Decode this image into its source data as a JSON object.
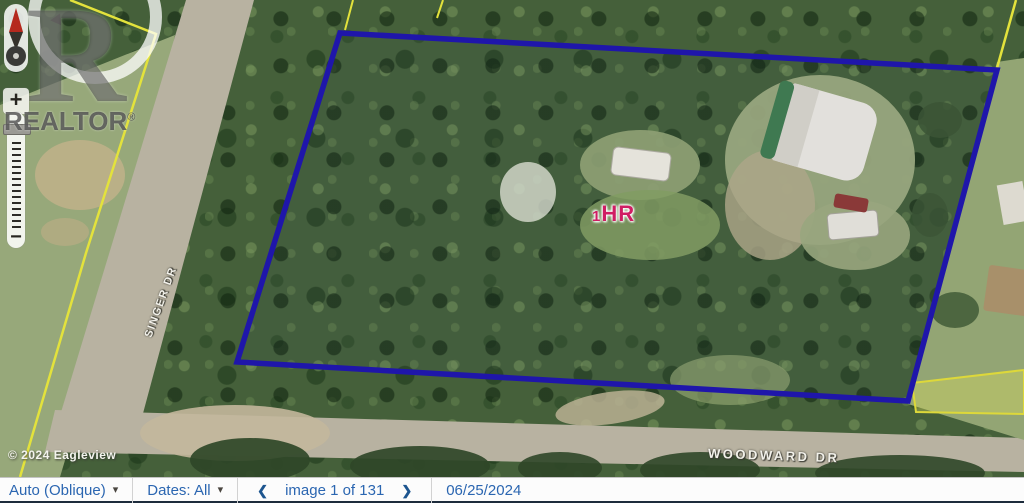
{
  "watermark": {
    "logo_letter": "R",
    "name": "REALTOR",
    "registered_mark": "®"
  },
  "zoom_control": {
    "zoom_in_label": "+",
    "zoom_out_label": "−"
  },
  "map": {
    "copyright": "© 2024 Eagleview",
    "street_labels": [
      {
        "text": "SINGER DR"
      },
      {
        "text": "WOODWARD DR"
      }
    ],
    "property_marker": {
      "prefix": "1",
      "text": "HR",
      "color": "#cf1e63"
    },
    "boundary_color": "#1f16aa",
    "neighbor_boundary_color": "#e3e23c"
  },
  "toolbar": {
    "view_mode_label": "Auto (Oblique)",
    "dates_label": "Dates: All",
    "caret_icon": "▾",
    "prev_icon": "❮",
    "next_icon": "❯",
    "image_counter": "image 1 of 131",
    "date": "06/25/2024",
    "text_color": "#2b66b1"
  }
}
